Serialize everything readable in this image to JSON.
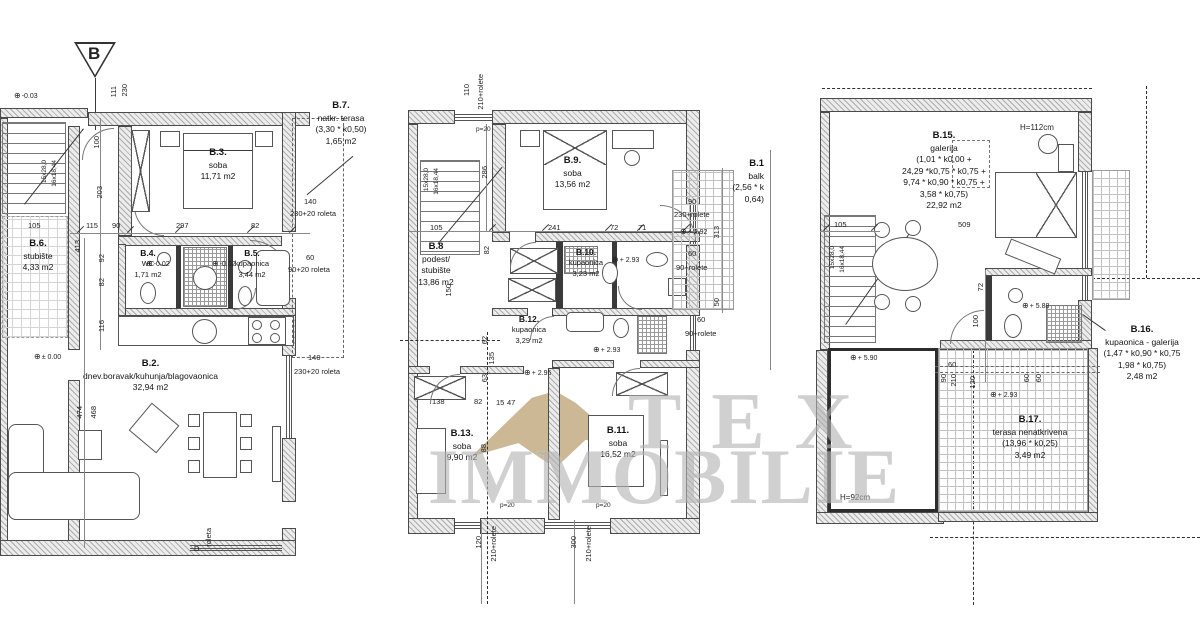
{
  "watermark": {
    "line1": "TEX",
    "line2": "IMMOBILIE",
    "text_color": "#b4b4b4",
    "logo_color": "#c9b48f"
  },
  "section": {
    "label": "B"
  },
  "icons": {
    "level": "⊕"
  },
  "left": {
    "rooms": {
      "b2": {
        "id": "B.2.",
        "name": "dnev.boravak/kuhunja/blagovaonica",
        "area": "32,94 m2"
      },
      "b3": {
        "id": "B.3.",
        "name": "soba",
        "area": "11,71 m2"
      },
      "b4": {
        "id": "B.4.",
        "name": "WC",
        "area": "1,71 m2"
      },
      "b5": {
        "id": "B.5.",
        "name": "kupaonica",
        "area": "3,44 m2"
      },
      "b6": {
        "id": "B.6.",
        "name": "stubište",
        "area": "4,33 m2"
      },
      "b7": {
        "id": "B.7.",
        "name": "natkr. terasa",
        "calc": "(3,30 * k0,50)",
        "area": "1,65 m2"
      }
    },
    "dims": [
      "111",
      "230",
      "105",
      "115",
      "90",
      "297",
      "82",
      "413",
      "100",
      "203",
      "92",
      "82",
      "116",
      "474",
      "468"
    ],
    "windows": [
      "140",
      "230+20 roleta",
      "60",
      "90+20 roleta",
      "140",
      "230+20 roleta",
      "roleta",
      "D"
    ],
    "levels": [
      "-0.03",
      "± 0.00",
      "-0.02",
      "-0.02"
    ],
    "stair": [
      "15x28,0",
      "16x18,44"
    ]
  },
  "mid": {
    "rooms": {
      "b8": {
        "id": "B.8",
        "name1": "podest/",
        "name2": "stubište",
        "area": "13,86 m2"
      },
      "b9": {
        "id": "B.9.",
        "name": "soba",
        "area": "13,56 m2"
      },
      "b10": {
        "id": "B.10.",
        "name": "kupaonica",
        "area": "3,23 m2"
      },
      "b11": {
        "id": "B.11.",
        "name": "soba",
        "area": "16,52 m2"
      },
      "b12": {
        "id": "B.12.",
        "name": "kupaonica",
        "area": "3,29 m2"
      },
      "b13": {
        "id": "B.13.",
        "name": "soba",
        "area": "9,90 m2"
      },
      "b14": {
        "id": "B.1",
        "name": "balk",
        "calc": "(2,56 * k",
        "area": "0,64)"
      }
    },
    "dims": [
      "110",
      "210+rolete",
      "286",
      "105",
      "241",
      "72",
      "71",
      "82",
      "150",
      "62",
      "135",
      "63",
      "138",
      "82",
      "15",
      "47",
      "88",
      "313",
      "50",
      "120",
      "210+rolete",
      "300",
      "210+rolete"
    ],
    "windows": [
      "90",
      "230+rolete",
      "60",
      "90+rolete",
      "60",
      "90+rolete"
    ],
    "levels": [
      "+ 2.93",
      "+ 2.95",
      "+ 2.93",
      "+ 2.92"
    ],
    "small": [
      "p=20",
      "p=20",
      "p=20"
    ],
    "stair": [
      "15x28,0",
      "16x18,44"
    ]
  },
  "right": {
    "rooms": {
      "b15": {
        "id": "B.15.",
        "name": "galerija",
        "calc1": "(1,01 * k0,00 +",
        "calc2": "24,29 *k0,75 * k0,75 +",
        "calc3": "9,74 * k0,90 * k0,75 +",
        "calc4": "3,58 * k0,75)",
        "area": "22,92 m2"
      },
      "b16": {
        "id": "B.16.",
        "name": "kupaonica - galerija",
        "calc1": "(1,47 * k0,90 * k0,75",
        "calc2": "1,98 * k0,75)",
        "area": "2,48 m2"
      },
      "b17": {
        "id": "B.17.",
        "name": "terasa nenatkrivena",
        "calc": "(13,96 * k0,25)",
        "area": "3,49 m2"
      }
    },
    "heights": [
      "H=112cm",
      "H=92cm"
    ],
    "dims": [
      "509",
      "105",
      "72",
      "100",
      "60",
      "90",
      "210",
      "120",
      "60",
      "60"
    ],
    "levels": [
      "+ 5.90",
      "+ 5.88",
      "+ 2.93"
    ],
    "stair": [
      "15x28,0",
      "16x18,44"
    ]
  }
}
